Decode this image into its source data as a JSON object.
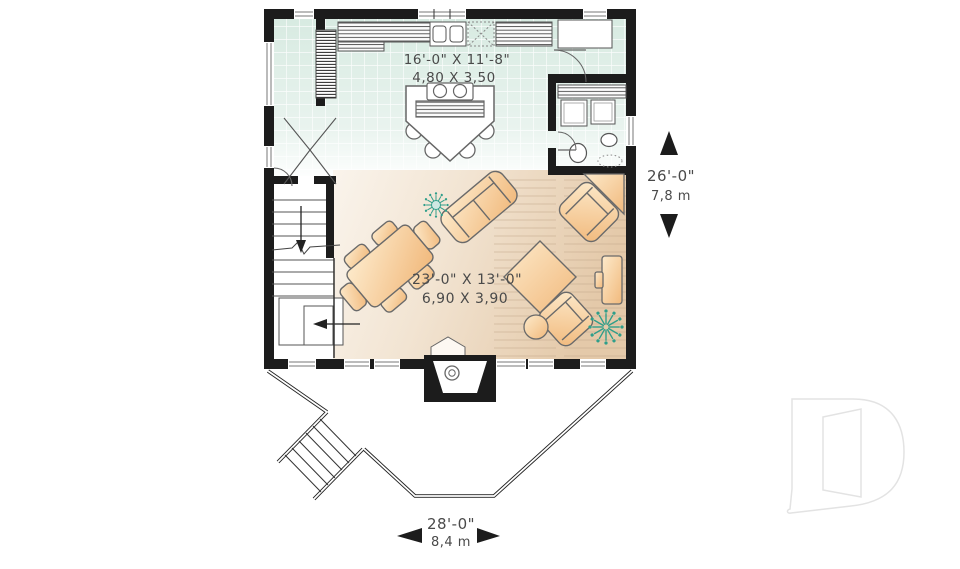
{
  "plan": {
    "kitchen": {
      "imperial": "16'-0\" X 11'-8\"",
      "metric": "4,80 X 3,50"
    },
    "living": {
      "imperial": "23'-0\" X 13'-0\"",
      "metric": "6,90 X 3,90"
    },
    "depth": {
      "imperial": "26'-0\"",
      "metric": "7,8 m"
    },
    "width": {
      "imperial": "28'-0\"",
      "metric": "8,4 m"
    }
  },
  "colors": {
    "wall": "#1c1c1c",
    "tile": "#d7eae1",
    "wood_floor": "#e6ccae",
    "furniture": "#f5c68e",
    "plant": "#2f9e8a",
    "label": "#4a4a4a",
    "logo": "#e3e3e3"
  }
}
